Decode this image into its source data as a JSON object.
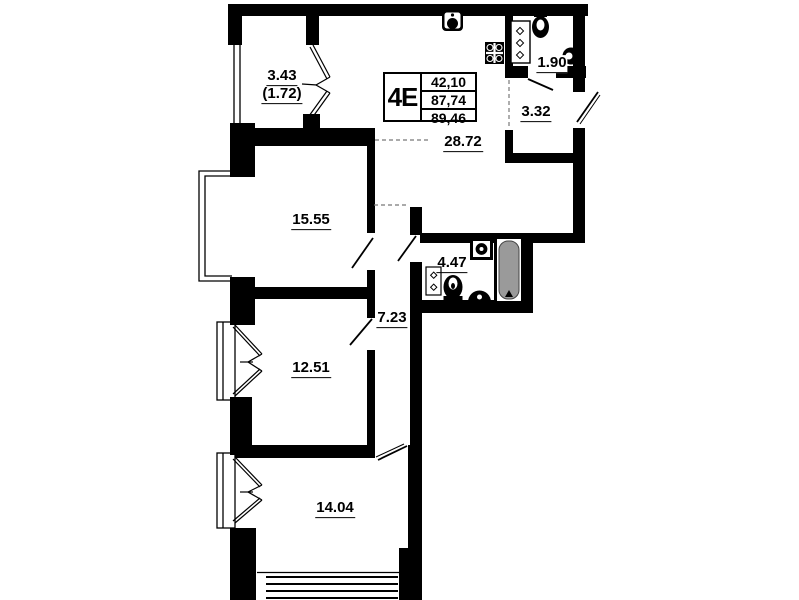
{
  "unit_box": {
    "type_label": "4E",
    "values": [
      "42,10",
      "87,74",
      "89,46"
    ]
  },
  "rooms": {
    "balcony": {
      "area": "3.43",
      "area_secondary": "(1.72)"
    },
    "living_kitchen": {
      "area": "28.72"
    },
    "wc": {
      "area": "1.90"
    },
    "hall": {
      "area": "3.32"
    },
    "room_top": {
      "area": "15.55"
    },
    "bathroom": {
      "area": "4.47"
    },
    "corridor": {
      "area": "7.23"
    },
    "room_middle": {
      "area": "12.51"
    },
    "room_bottom": {
      "area": "14.04"
    }
  },
  "icons": [
    "kitchen-sink-icon",
    "stove-icon",
    "wc-cabinet-icon",
    "wc-toilet-icon",
    "wc-basin-icon",
    "bath-sink-icon",
    "bathtub-icon",
    "bath-cabinet-icon",
    "bath-toilet-icon",
    "washing-machine-icon"
  ],
  "colors": {
    "wall": "#000000",
    "bathtub": "#9a9a9a",
    "background": "#ffffff",
    "dashed": "#777777"
  }
}
